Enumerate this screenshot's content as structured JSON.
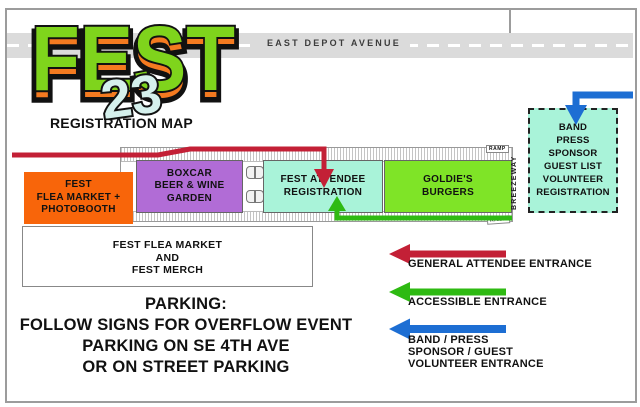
{
  "header": {
    "road_label": "EAST DEPOT AVENUE",
    "logo_title": "FEST",
    "logo_year": "23",
    "logo_subtitle": "REGISTRATION MAP",
    "logo_colors": {
      "flame_orange": "#f47a20",
      "letter_green": "#7fd41c",
      "year_aqua": "#d5f0ec"
    }
  },
  "venue": {
    "booths": [
      {
        "lines": [
          "FEST",
          "FLEA MARKET +",
          "PHOTOBOOTH"
        ],
        "color": "#f8650a"
      },
      {
        "lines": [
          "BOXCAR",
          "BEER & WINE",
          "GARDEN"
        ],
        "color": "#b16cd6"
      },
      {
        "lines": [
          "FEST ATTENDEE",
          "REGISTRATION"
        ],
        "color": "#a9f3d9"
      },
      {
        "lines": [
          "GOLDIE'S",
          "BURGERS"
        ],
        "color": "#7fe427"
      }
    ],
    "band_registration": {
      "lines": [
        "BAND",
        "PRESS",
        "SPONSOR",
        "GUEST LIST",
        "VOLUNTEER",
        "REGISTRATION"
      ],
      "color": "#a9f3d9"
    },
    "merch": {
      "lines": [
        "FEST FLEA MARKET",
        "AND",
        "FEST MERCH"
      ]
    },
    "breezeway_label": "BREEZEWAY",
    "ramp_top": "RAMP",
    "ramp_bottom": "RAMP"
  },
  "routes": [
    {
      "name": "general-attendee-route",
      "color": "#c32036"
    },
    {
      "name": "accessible-route",
      "color": "#2eba12"
    },
    {
      "name": "band-press-route",
      "color": "#1d6ed3"
    }
  ],
  "legend": [
    {
      "lines": [
        "GENERAL ATTENDEE ENTRANCE"
      ],
      "color": "#c32036"
    },
    {
      "lines": [
        "ACCESSIBLE ENTRANCE"
      ],
      "color": "#2eba12"
    },
    {
      "lines": [
        "BAND / PRESS",
        "SPONSOR / GUEST",
        "VOLUNTEER ENTRANCE"
      ],
      "color": "#1d6ed3"
    }
  ],
  "parking": {
    "lines": [
      "PARKING:",
      "FOLLOW SIGNS FOR OVERFLOW EVENT",
      "PARKING ON SE 4TH AVE",
      "OR ON STREET PARKING"
    ]
  }
}
